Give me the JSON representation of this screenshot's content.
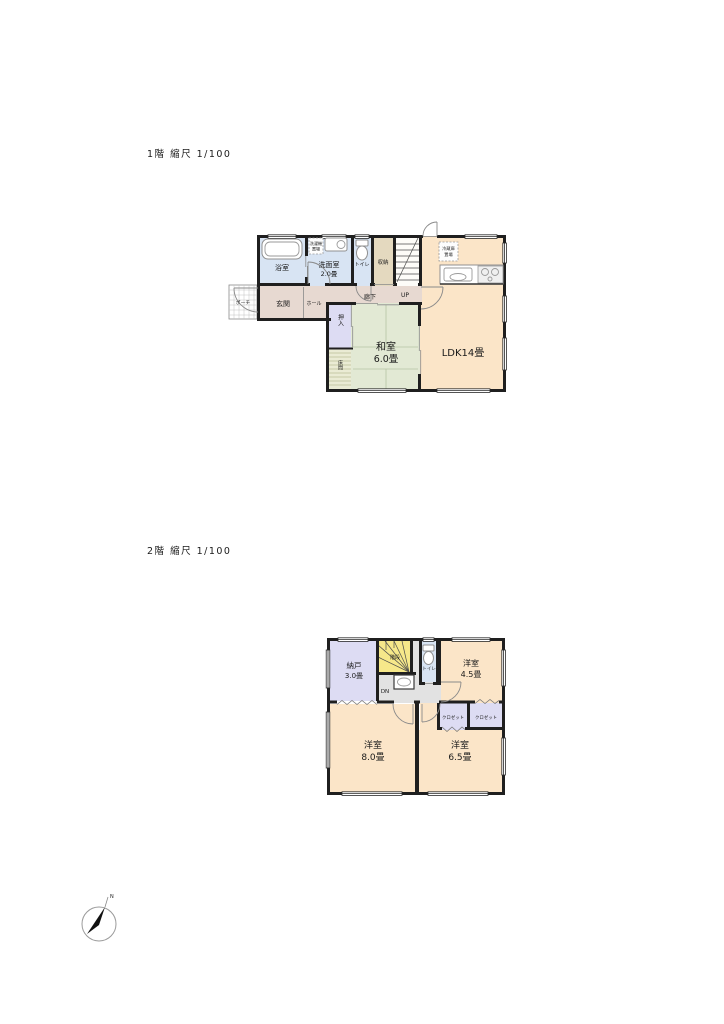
{
  "titles": {
    "floor1": "1階 縮尺 1/100",
    "floor2": "2階 縮尺 1/100"
  },
  "floor1": {
    "bath": "浴室",
    "washroom_name": "洗面室",
    "washroom_size": "2.0畳",
    "washer_line1": "洗濯機",
    "washer_line2": "置場",
    "toilet": "トイレ",
    "storage": "収納",
    "stairs_up": "UP",
    "corridor": "廊下",
    "porch": "ポーチ",
    "entrance": "玄関",
    "hall": "ホール",
    "oshiire": "押入",
    "tokonoma": "床間",
    "washitsu_name": "和室",
    "washitsu_size": "6.0畳",
    "ldk": "LDK14畳",
    "fridge_line1": "冷蔵庫",
    "fridge_line2": "置場"
  },
  "floor2": {
    "nando_name": "納戸",
    "nando_size": "3.0畳",
    "stairs": "階段",
    "stairs_down": "DN",
    "toilet": "トイレ",
    "room45_name": "洋室",
    "room45_size": "4.5畳",
    "closet_left": "クロゼット",
    "closet_right": "クロゼット",
    "room80_name": "洋室",
    "room80_size": "8.0畳",
    "room65_name": "洋室",
    "room65_size": "6.5畳"
  },
  "compass": {
    "north": "N"
  },
  "colors": {
    "c-wall": "#1f1f1f",
    "c-water": "#d8e4f3",
    "c-tan": "#e4d9bf",
    "c-rose": "#e7d9d1",
    "c-lav": "#dddcf3",
    "c-tatami": "#e2e9d4",
    "c-toko": "#eaebd4",
    "c-peach": "#fbe5c8",
    "c-stair": "#f6e88a",
    "c-hall": "#e2e2e2"
  }
}
